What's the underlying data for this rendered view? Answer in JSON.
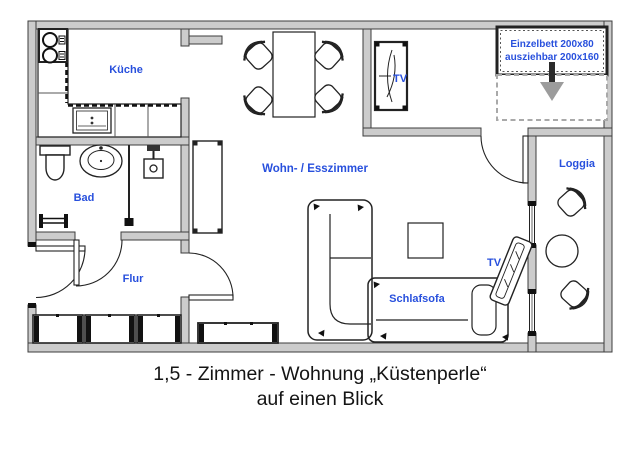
{
  "plan": {
    "labels": {
      "kitchen": "Küche",
      "bath": "Bad",
      "hall": "Flur",
      "living_dining": "Wohn- / Esszimmer",
      "loggia": "Loggia",
      "sleeper_sofa": "Schlafsofa",
      "tv_room": "TV",
      "tv_living": "TV",
      "bed_line1": "Einzelbett 200x80",
      "bed_line2": "ausziehbar 200x160"
    },
    "colors": {
      "label_blue": "#2850dd",
      "wall_fill": "#cccccc",
      "wall_outline": "#3d3d3d",
      "arrow_gray": "#9c9c9c",
      "extension_dash_gray": "#a9a9a9"
    }
  },
  "caption": {
    "line1": "1,5 - Zimmer - Wohnung „Küstenperle“",
    "line2": "auf einen Blick"
  }
}
